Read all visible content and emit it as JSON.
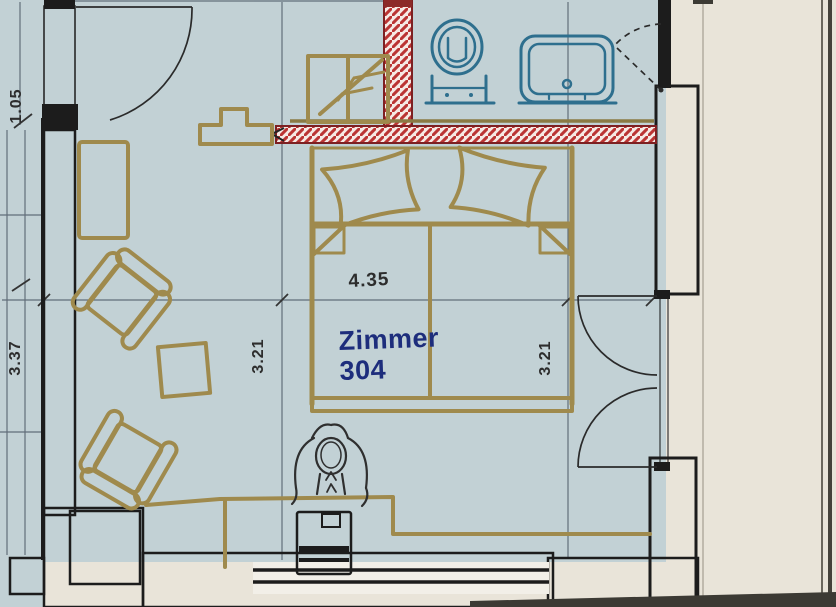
{
  "floorplan": {
    "room": {
      "name": "Zimmer",
      "number": "304"
    },
    "dimensions": {
      "bed_wall_width": "4.35",
      "inner_height_left": "3.21",
      "inner_height_right": "3.21",
      "outer_left_height": "3.37",
      "entry_opening": "1.05"
    },
    "colors": {
      "floor": "#c2d1d5",
      "paper": "#e9e4d9",
      "furniture_line": "#9f8a4d",
      "wall_red": "#bb3433",
      "wall_red_border": "#7d2022",
      "fixture_blue": "#2e6f8e",
      "label_blue": "#1d2d7c",
      "line_dark": "#1c1c1c",
      "dimension_text": "#2d2d2d"
    }
  }
}
